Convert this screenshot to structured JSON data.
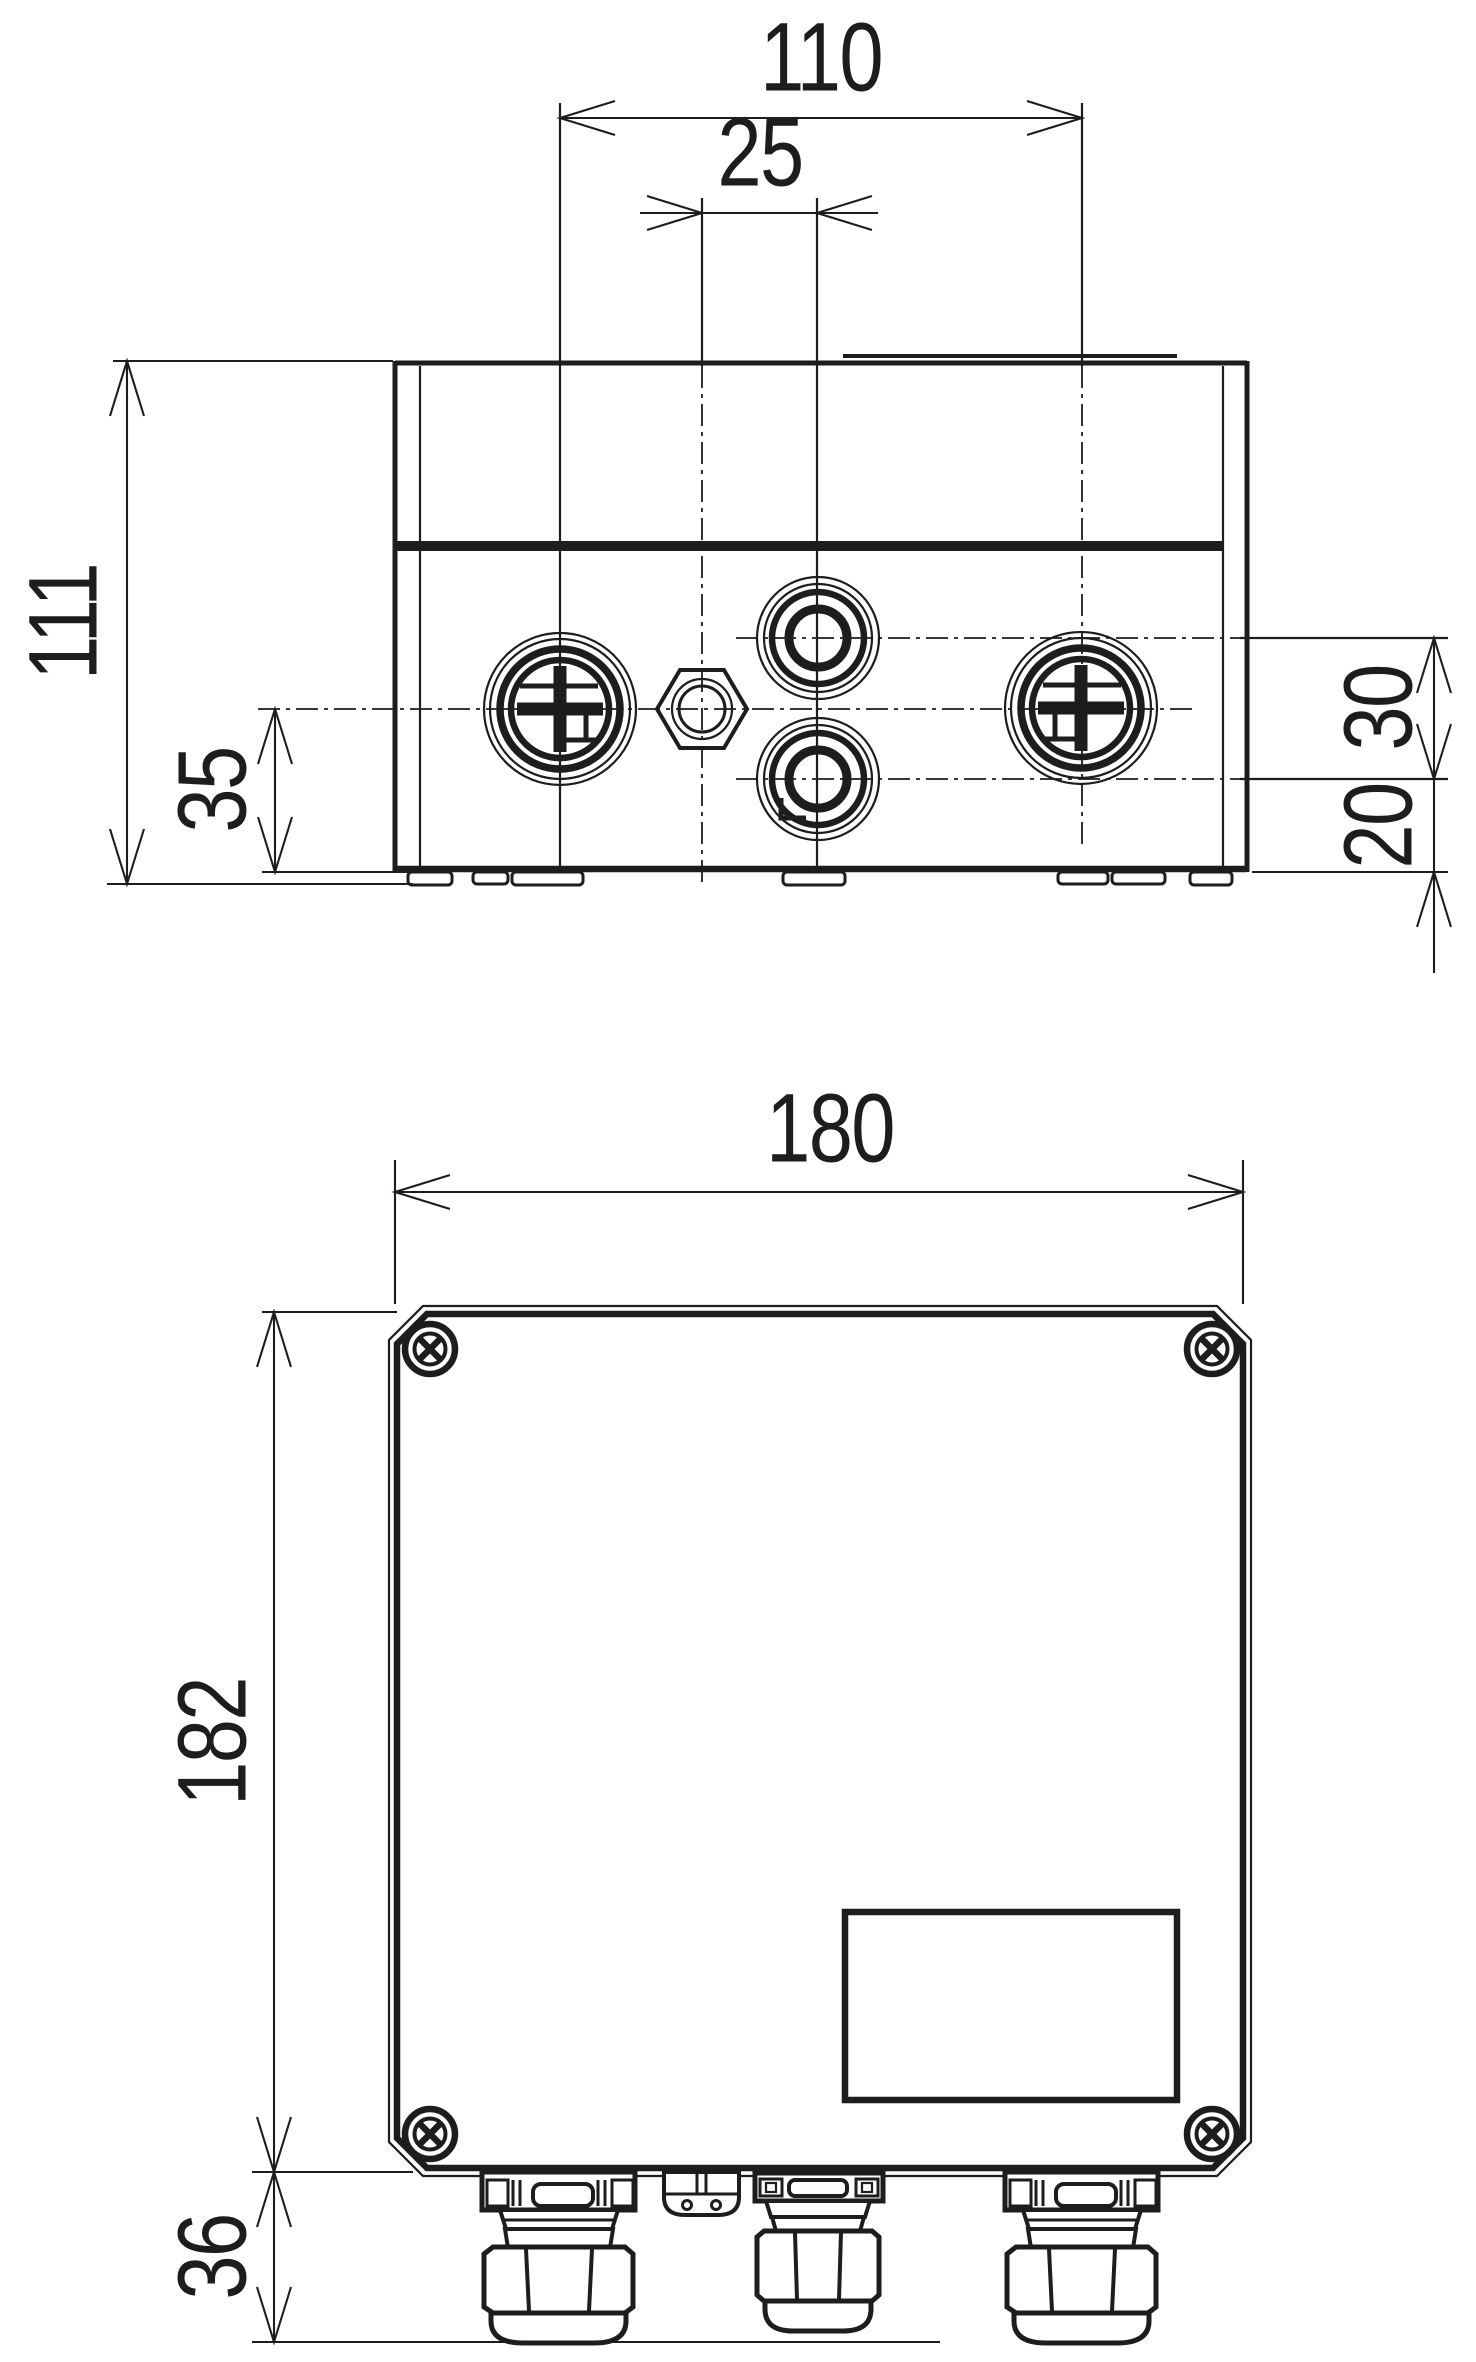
{
  "meta": {
    "background_color": "#ffffff",
    "line_color": "#1d1d1d",
    "drawing_type": "technical dimension drawing, enclosure with cable glands, two views"
  },
  "dims": {
    "d110": "110",
    "d25": "25",
    "d111": "111",
    "d35": "35",
    "d30": "30",
    "d20": "20",
    "d180": "180",
    "d182": "182",
    "d36": "36"
  }
}
